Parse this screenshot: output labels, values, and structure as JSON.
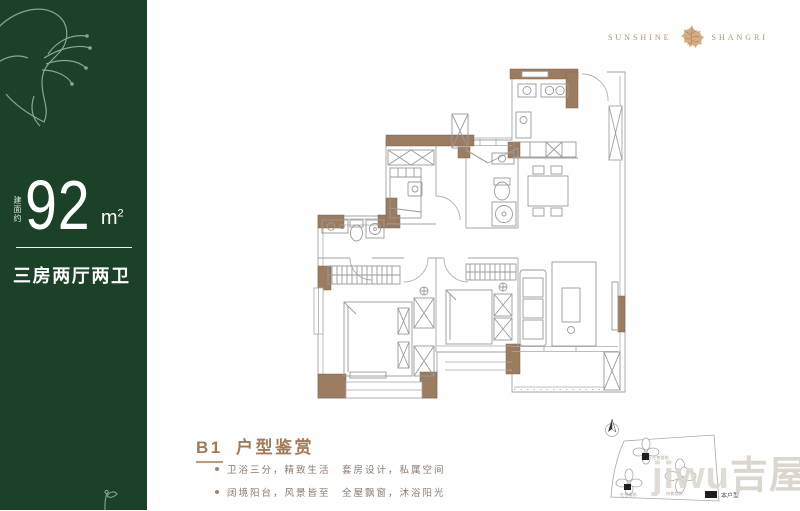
{
  "panel": {
    "area_prefix": "建面约",
    "area_value": "92",
    "area_unit": "m",
    "area_sup": "2",
    "layout_text": "三房两厅两卫"
  },
  "logo": {
    "left": "SUNSHINE",
    "right": "SHANGRI"
  },
  "listing": {
    "title_code": "B1",
    "title_text": "户型鉴赏",
    "bullets": [
      {
        "text": "卫浴三分，精致生活　套房设计，私属空间"
      },
      {
        "text": "阔境阳台，风景皆至　全屋飘窗，沐浴阳光"
      }
    ]
  },
  "siteplan": {
    "labels": [
      "在售楼栋",
      "在售楼栋",
      "待售楼栋"
    ],
    "legend_label": "本户型"
  },
  "watermark": {
    "latin": "jiwu",
    "cjk": "吉屋"
  },
  "colors": {
    "panel_green": "#1c4129",
    "wall_brown": "#9c7c60",
    "accent_gold": "#bf9a74",
    "title_brown": "#a27a54",
    "body_text": "#8d7a6e"
  }
}
